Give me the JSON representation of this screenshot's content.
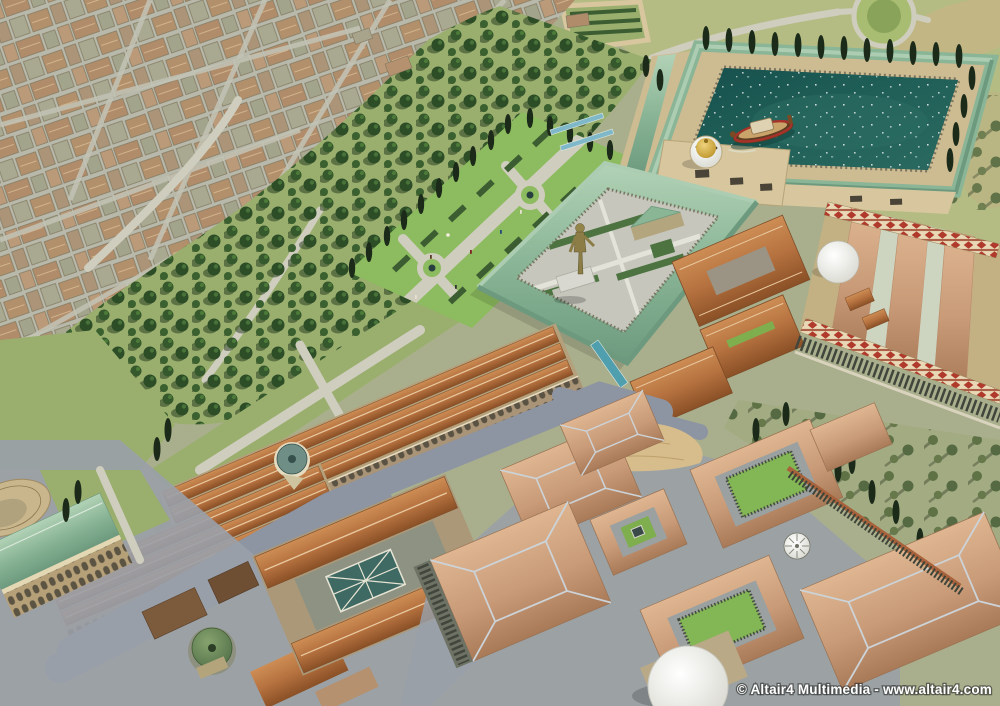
{
  "watermark": {
    "text": "© Altair4 Multimedia - www.altair4.com"
  },
  "palette": {
    "ground_sage": "#a9af8c",
    "lawn": "#b4bc84",
    "grass_park": "#9aaf6e",
    "grass_bright": "#8dbb5f",
    "tree_dark": "#2c4d26",
    "cypress": "#1c2b19",
    "water": "#1d5955",
    "water_light": "#2e6e64",
    "roof_verdigris": "#8ab596",
    "roof_terracotta": "#b5713f",
    "roof_salmon": "#c99b78",
    "roof_city_tan": "#b3906c",
    "wall_cream": "#cdbb92",
    "terrace": "#d8c79e",
    "path": "#cfcdbe",
    "street": "#8d94a2",
    "mosaic_cream": "#e8d8b6",
    "mosaic_red": "#b03a2c",
    "gold": "#c8a23c",
    "dome_white": "#eceae2",
    "dome_green": "#5f7d52",
    "colonnade_dark": "#3e4438",
    "sand": "#d7bd8c",
    "watermark_color": "#ffffff"
  }
}
